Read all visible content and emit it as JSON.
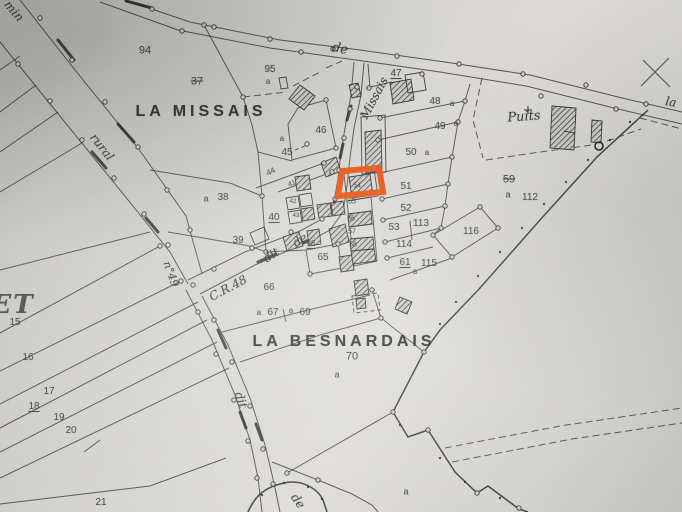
{
  "colors": {
    "highlight_box": "#e8500f",
    "ink": "#2e2d2b",
    "paper": "#d2d1ce"
  },
  "highlight": {
    "label": "54"
  },
  "map": {
    "labels": [
      {
        "t": "min",
        "x": 14,
        "y": 11,
        "s": 12,
        "r": 50,
        "c": "r",
        "name": "road-label-chemin"
      },
      {
        "t": "rural",
        "x": 102,
        "y": 147,
        "s": 12,
        "r": 52,
        "c": "r",
        "name": "road-label-rural"
      },
      {
        "t": "n°49",
        "x": 171,
        "y": 274,
        "s": 11,
        "r": 70,
        "c": "r",
        "name": "road-label-n49"
      },
      {
        "t": "C.R.48",
        "x": 228,
        "y": 288,
        "s": 12,
        "r": -28,
        "c": "r",
        "name": "road-label-cr48"
      },
      {
        "t": "dit",
        "x": 271,
        "y": 255,
        "s": 12,
        "r": -33,
        "c": "r"
      },
      {
        "t": "de",
        "x": 300,
        "y": 240,
        "s": 12,
        "r": -33,
        "c": "r"
      },
      {
        "t": "Missais",
        "x": 374,
        "y": 98,
        "s": 12,
        "r": -62,
        "c": "r",
        "name": "road-label-missais"
      },
      {
        "t": "de",
        "x": 340,
        "y": 49,
        "s": 13,
        "r": 12,
        "c": "r"
      },
      {
        "t": "la",
        "x": 671,
        "y": 102,
        "s": 12,
        "r": 10,
        "c": "r"
      },
      {
        "t": "dit",
        "x": 241,
        "y": 400,
        "s": 12,
        "r": 72,
        "c": "r"
      },
      {
        "t": "de",
        "x": 298,
        "y": 501,
        "s": 12,
        "r": 55,
        "c": "r"
      },
      {
        "t": "Puits",
        "x": 524,
        "y": 117,
        "s": 13,
        "r": -4,
        "c": "r",
        "name": "well-label"
      },
      {
        "t": "LA MISSAIS",
        "x": 201,
        "y": 112,
        "s": 16,
        "c": "p",
        "name": "place-name-la-missais"
      },
      {
        "t": "LA BESNARDAIS",
        "x": 344,
        "y": 342,
        "s": 16,
        "c": "p",
        "name": "place-name-la-besnardais"
      },
      {
        "t": "ET",
        "x": 13,
        "y": 305,
        "s": 26,
        "c": "e",
        "name": "place-name-partial"
      },
      {
        "t": "94",
        "x": 145,
        "y": 51,
        "s": 11
      },
      {
        "t": "37",
        "x": 197,
        "y": 82,
        "s": 11,
        "k": 1
      },
      {
        "t": "95",
        "x": 270,
        "y": 70,
        "s": 10
      },
      {
        "t": "a",
        "x": 268,
        "y": 82,
        "s": 8
      },
      {
        "t": "47",
        "x": 396,
        "y": 74,
        "s": 10,
        "u": 1
      },
      {
        "t": "48",
        "x": 435,
        "y": 102,
        "s": 10
      },
      {
        "t": "a",
        "x": 452,
        "y": 104,
        "s": 8
      },
      {
        "t": "46",
        "x": 321,
        "y": 131,
        "s": 10
      },
      {
        "t": "a",
        "x": 282,
        "y": 139,
        "s": 8
      },
      {
        "t": "49",
        "x": 440,
        "y": 127,
        "s": 10
      },
      {
        "t": "a",
        "x": 456,
        "y": 124,
        "s": 8
      },
      {
        "t": "45",
        "x": 287,
        "y": 153,
        "s": 10
      },
      {
        "t": "50",
        "x": 411,
        "y": 153,
        "s": 10
      },
      {
        "t": "a",
        "x": 427,
        "y": 153,
        "s": 8
      },
      {
        "t": "44",
        "x": 271,
        "y": 172,
        "s": 8,
        "r": -28
      },
      {
        "t": "41",
        "x": 292,
        "y": 184,
        "s": 7,
        "r": -20
      },
      {
        "t": "a",
        "x": 206,
        "y": 199,
        "s": 9
      },
      {
        "t": "38",
        "x": 223,
        "y": 198,
        "s": 10
      },
      {
        "t": "51",
        "x": 406,
        "y": 187,
        "s": 10
      },
      {
        "t": "54",
        "x": 357,
        "y": 186,
        "s": 7
      },
      {
        "t": "40",
        "x": 274,
        "y": 218,
        "s": 10,
        "u": 1
      },
      {
        "t": "42",
        "x": 293,
        "y": 202,
        "s": 6
      },
      {
        "t": "43",
        "x": 296,
        "y": 216,
        "s": 6
      },
      {
        "t": "55",
        "x": 352,
        "y": 202,
        "s": 7
      },
      {
        "t": "52",
        "x": 406,
        "y": 209,
        "s": 10
      },
      {
        "t": "56",
        "x": 351,
        "y": 219,
        "s": 7
      },
      {
        "t": "57",
        "x": 352,
        "y": 232,
        "s": 7
      },
      {
        "t": "53",
        "x": 394,
        "y": 228,
        "s": 10
      },
      {
        "t": "113",
        "x": 421,
        "y": 224,
        "s": 10
      },
      {
        "t": "58",
        "x": 353,
        "y": 245,
        "s": 7
      },
      {
        "t": "39",
        "x": 238,
        "y": 241,
        "s": 10
      },
      {
        "t": "96",
        "x": 311,
        "y": 244,
        "s": 8,
        "u": 1
      },
      {
        "t": "114",
        "x": 404,
        "y": 245,
        "s": 10
      },
      {
        "t": "116",
        "x": 471,
        "y": 232,
        "s": 10
      },
      {
        "t": "65",
        "x": 323,
        "y": 258,
        "s": 10
      },
      {
        "t": "61",
        "x": 405,
        "y": 263,
        "s": 10,
        "u": 1
      },
      {
        "t": "115",
        "x": 429,
        "y": 264,
        "s": 10
      },
      {
        "t": "a",
        "x": 415,
        "y": 272,
        "s": 8
      },
      {
        "t": "59",
        "x": 509,
        "y": 180,
        "s": 11,
        "k": 1
      },
      {
        "t": "a",
        "x": 508,
        "y": 195,
        "s": 9
      },
      {
        "t": "112",
        "x": 530,
        "y": 198,
        "s": 10
      },
      {
        "t": "66",
        "x": 269,
        "y": 288,
        "s": 10
      },
      {
        "t": "a",
        "x": 259,
        "y": 313,
        "s": 8
      },
      {
        "t": "67",
        "x": 273,
        "y": 313,
        "s": 10
      },
      {
        "t": "a",
        "x": 291,
        "y": 311,
        "s": 8
      },
      {
        "t": "69",
        "x": 305,
        "y": 313,
        "s": 10
      },
      {
        "t": "70",
        "x": 352,
        "y": 357,
        "s": 11
      },
      {
        "t": "a",
        "x": 337,
        "y": 375,
        "s": 9
      },
      {
        "t": "15",
        "x": 15,
        "y": 323,
        "s": 10
      },
      {
        "t": "16",
        "x": 28,
        "y": 358,
        "s": 10
      },
      {
        "t": "17",
        "x": 49,
        "y": 392,
        "s": 10
      },
      {
        "t": "18",
        "x": 34,
        "y": 407,
        "s": 10,
        "u": 1
      },
      {
        "t": "19",
        "x": 59,
        "y": 418,
        "s": 10
      },
      {
        "t": "20",
        "x": 71,
        "y": 431,
        "s": 10
      },
      {
        "t": "21",
        "x": 101,
        "y": 503,
        "s": 10
      },
      {
        "t": "a",
        "x": 406,
        "y": 492,
        "s": 9
      }
    ]
  }
}
